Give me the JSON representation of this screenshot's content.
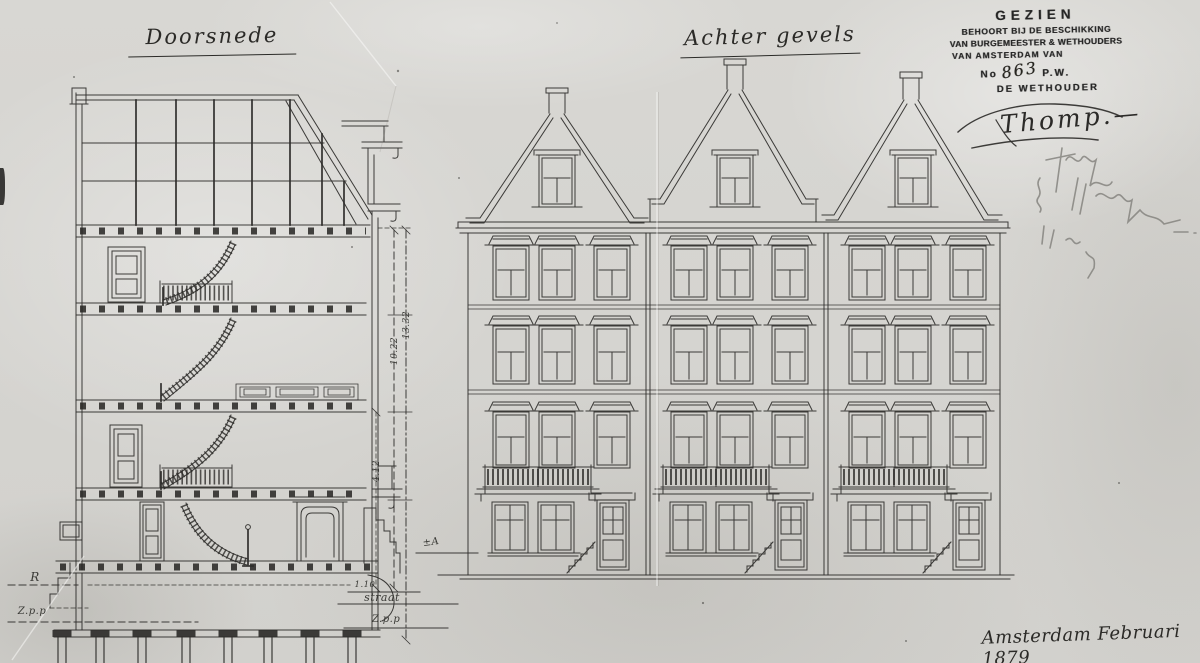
{
  "paper": {
    "background": "#d6d5d1",
    "ink": "#2e2d2a",
    "pencil": "#85847f"
  },
  "titles": {
    "section": "Doorsnede",
    "facades": "Achter gevels"
  },
  "stamp": {
    "line1": "GEZIEN",
    "line2": "BEHOORT BIJ DE BESCHIKKING",
    "line3": "VAN BURGEMEESTER & WETHOUDERS",
    "line4": "VAN AMSTERDAM VAN",
    "no_label": "No",
    "no_value": "863",
    "no_suffix": "P.W.",
    "line6": "DE WETHOUDER"
  },
  "signature": {
    "name": "Thomp",
    "flourish": ".—"
  },
  "footer": {
    "date_note": "Amsterdam Februari 1879"
  },
  "dimensions": {
    "height_outer": "13.32",
    "height_inner": "10.22",
    "height_lower": "4.12",
    "stoop": "1.10",
    "street": "straat",
    "datum_left": "R",
    "datum_left_low": "Z.p.p",
    "datum_right_low": "Z.p.p",
    "ground_mark": "±A"
  }
}
